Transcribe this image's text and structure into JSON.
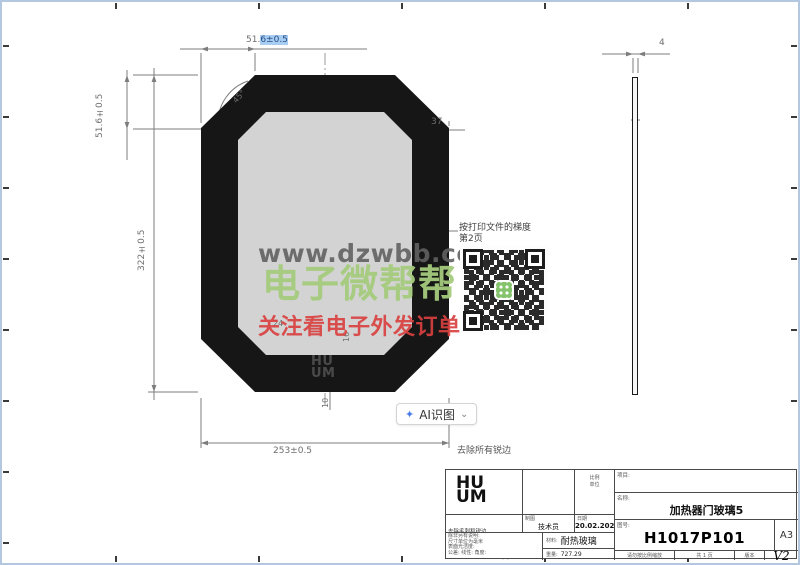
{
  "watermark": {
    "url": "www.dzwbb.com",
    "brand": "电子微帮帮",
    "slogan": "关注看电子外发订单"
  },
  "ai_button": {
    "label": "AI识图",
    "icon_glyph": "✦",
    "chevron_glyph": "⌄"
  },
  "notes": {
    "print_note_line1": "按打印文件的梯度",
    "print_note_line2": "第2页",
    "edge_note": "去除所有锐边"
  },
  "dimensions": {
    "top_chamfer_prefix": "51.",
    "top_chamfer_selected": "6±0.5",
    "left_chamfer": "51.6±0.5",
    "height": "322±0.5",
    "angle": "45°",
    "border_width": "37",
    "width": "253±0.5",
    "logo_width": "24",
    "logo_height": "16",
    "logo_offset": "10",
    "thickness": "4"
  },
  "emboss": {
    "line1": "HU",
    "line2": "UM"
  },
  "title_block": {
    "logo_line1": "HU",
    "logo_line2": "UM",
    "scale_label": "比例",
    "unit_label": "单位",
    "project_label": "项目:",
    "name_label": "名称:",
    "name": "加热器门玻璃5",
    "deburr_note": "去除毛刺和锐边",
    "drawn_label": "制图",
    "drawn_value": "技术员",
    "date_label": "日期",
    "date_value": "20.02.2024",
    "tol_line1": "除非另有说明:",
    "tol_line2": "尺寸单位为毫米",
    "tol_line3": "表面光洁度:",
    "tol_line4": "公差:  线性:  角度:",
    "tol_std": "ISO 2768中级",
    "material_label": "材料:",
    "material": "耐热玻璃",
    "weight_label": "重量:",
    "weight": "727.29",
    "dwg_no_label": "图号:",
    "dwg_no": "H1017P101",
    "paper_size": "A3",
    "noscale_note": "请勿按比例缩放",
    "sheet_info": "共 1 页",
    "rev_label": "版本",
    "revision": "V2"
  }
}
